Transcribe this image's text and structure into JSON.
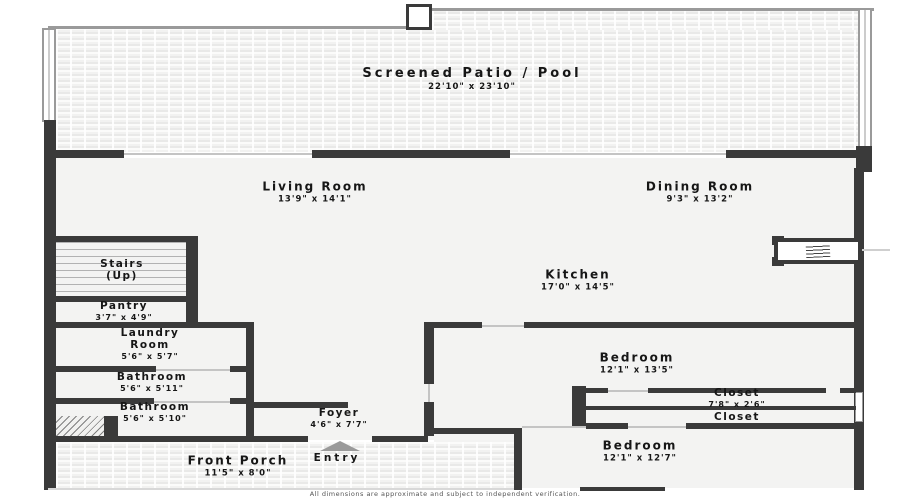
{
  "rooms": {
    "patio": {
      "label": "Screened Patio / Pool",
      "dims": "22'10\" x 23'10\""
    },
    "living": {
      "label": "Living Room",
      "dims": "13'9\" x 14'1\""
    },
    "dining": {
      "label": "Dining Room",
      "dims": "9'3\" x 13'2\""
    },
    "kitchen": {
      "label": "Kitchen",
      "dims": "17'0\" x 14'5\""
    },
    "stairs": {
      "label": "Stairs (Up)",
      "dims": ""
    },
    "pantry": {
      "label": "Pantry",
      "dims": "3'7\" x 4'9\""
    },
    "laundry": {
      "label": "Laundry Room",
      "dims": "5'6\" x 5'7\""
    },
    "bathroom_upper": {
      "label": "Bathroom",
      "dims": "5'6\" x 5'11\""
    },
    "bathroom_lower": {
      "label": "Bathroom",
      "dims": "5'6\" x 5'10\""
    },
    "bedroom_upper": {
      "label": "Bedroom",
      "dims": "12'1\" x 13'5\""
    },
    "closet_upper": {
      "label": "Closet",
      "dims": "7'8\" x 2'6\""
    },
    "closet_lower": {
      "label": "Closet",
      "dims": ""
    },
    "bedroom_lower": {
      "label": "Bedroom",
      "dims": "12'1\" x 12'7\""
    },
    "foyer": {
      "label": "Foyer",
      "dims": "4'6\" x 7'7\""
    },
    "entry": {
      "label": "Entry",
      "dims": ""
    },
    "porch": {
      "label": "Front Porch",
      "dims": "11'5\" x 8'0\""
    }
  },
  "footer": {
    "disclaimer": "All dimensions are approximate and subject to independent verification."
  },
  "colors": {
    "wall": "#3a3a3a",
    "floor": "#f3f3f2",
    "screen_enclosure_line": "#9a9a9a",
    "label_text": "#161616"
  }
}
